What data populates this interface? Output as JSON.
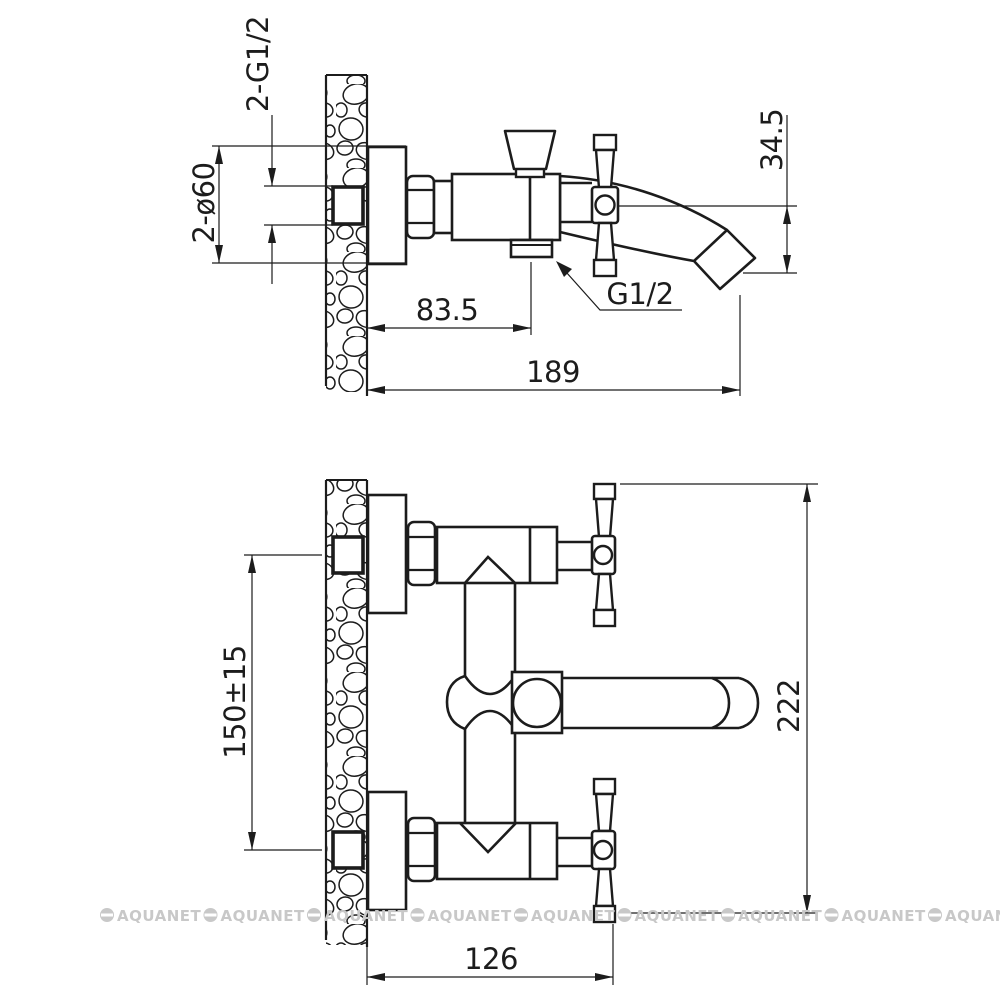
{
  "page": {
    "background": "#ffffff",
    "line_color": "#1c1c1c"
  },
  "dims": {
    "inlet_threads": "2-G1/2",
    "flange_diameter": "2-ø60",
    "spout_drop": "34.5",
    "outlet_thread": "G1/2",
    "wall_to_outlet": "83.5",
    "total_reach": "189",
    "inlet_spacing": "150±15",
    "overall_height": "222",
    "wall_to_handle": "126"
  },
  "watermark": {
    "text": "AQUANET",
    "color": "#c8c8c8",
    "count": 9
  }
}
